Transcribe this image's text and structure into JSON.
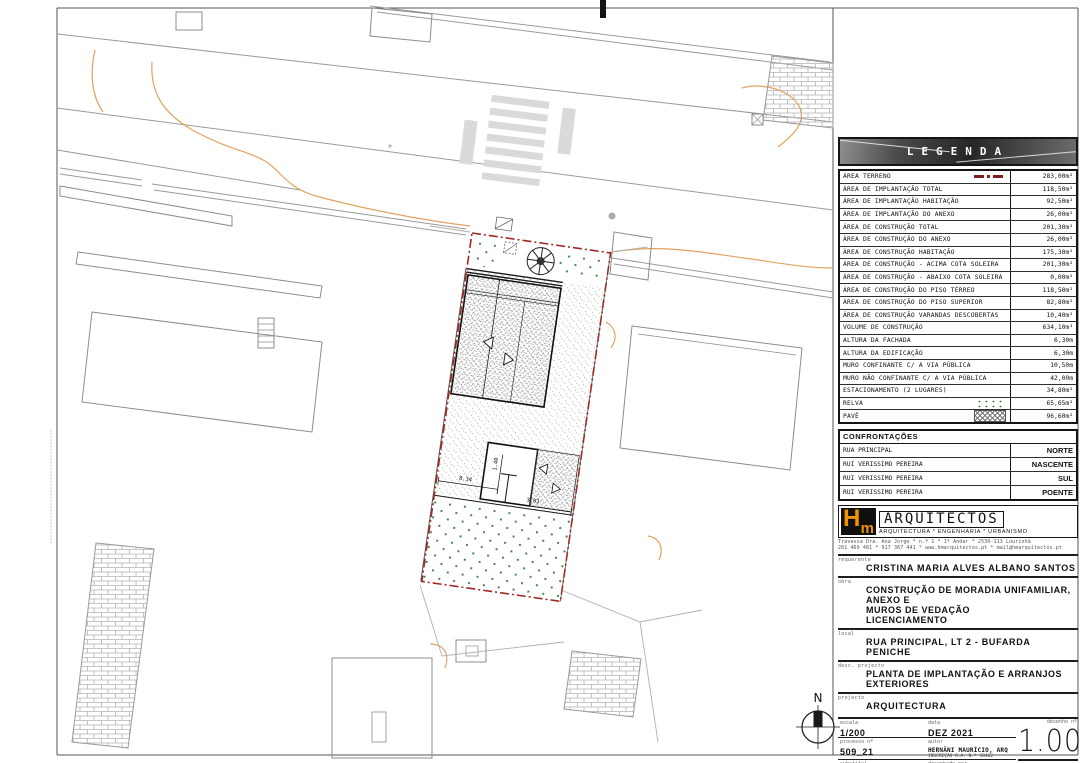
{
  "legend": {
    "title": "LEGENDA",
    "rows": [
      {
        "label": "ÁREA TERRENO",
        "value": "283,00m²",
        "symbol": "terrain"
      },
      {
        "label": "ÁREA DE IMPLANTAÇÃO TOTAL",
        "value": "118,50m²",
        "symbol": null
      },
      {
        "label": "ÁREA DE IMPLANTAÇÃO HABITAÇÃO",
        "value": "92,50m²",
        "symbol": null
      },
      {
        "label": "ÁREA DE IMPLANTAÇÃO DO ANEXO",
        "value": "26,00m²",
        "symbol": null
      },
      {
        "label": "ÁREA DE CONSTRUÇÃO TOTAL",
        "value": "201,30m²",
        "symbol": null
      },
      {
        "label": "ÁREA DE CONSTRUÇÃO DO ANEXO",
        "value": "26,00m²",
        "symbol": null
      },
      {
        "label": "ÁREA DE CONSTRUÇÃO HABITAÇÃO",
        "value": "175,30m²",
        "symbol": null
      },
      {
        "label": "ÁREA DE CONSTRUÇÃO - ACIMA COTA SOLEIRA",
        "value": "201,30m²",
        "symbol": null
      },
      {
        "label": "ÁREA DE CONSTRUÇÃO - ABAIXO COTA SOLEIRA",
        "value": "0,00m²",
        "symbol": null
      },
      {
        "label": "ÁREA DE CONSTRUÇÃO DO PISO TÉRREO",
        "value": "118,50m²",
        "symbol": null
      },
      {
        "label": "ÁREA DE CONSTRUÇÃO DO PISO SUPERIOR",
        "value": "82,80m²",
        "symbol": null
      },
      {
        "label": "ÁREA DE CONSTRUÇÃO VARANDAS DESCOBERTAS",
        "value": "10,40m²",
        "symbol": null
      },
      {
        "label": "VOLUME DE CONSTRUÇÃO",
        "value": "634,10m³",
        "symbol": null
      },
      {
        "label": "ALTURA DA FACHADA",
        "value": "6,30m",
        "symbol": null
      },
      {
        "label": "ALTURA DA EDIFICAÇÃO",
        "value": "6,30m",
        "symbol": null
      },
      {
        "label": "MURO CONFINANTE C/ A VIA PÚBLICA",
        "value": "10,50m",
        "symbol": null
      },
      {
        "label": "MURO NÃO CONFINANTE C/ A VIA PÚBLICA",
        "value": "42,00m",
        "symbol": null
      },
      {
        "label": "ESTACIONAMENTO (2 LUGARES)",
        "value": "34,80m²",
        "symbol": null
      },
      {
        "label": "RELVA",
        "value": "65,65m²",
        "symbol": "grass"
      },
      {
        "label": "PAVÊ",
        "value": "96,60m²",
        "symbol": "pave"
      }
    ]
  },
  "confrontations": {
    "title": "CONFRONTAÇÕES",
    "rows": [
      {
        "label": "RUA PRINCIPAL",
        "value": "NORTE"
      },
      {
        "label": "RUI VERISSIMO PEREIRA",
        "value": "NASCENTE"
      },
      {
        "label": "RUI VERISSIMO PEREIRA",
        "value": "SUL"
      },
      {
        "label": "RUI VERISSIMO PEREIRA",
        "value": "POENTE"
      }
    ]
  },
  "firm": {
    "logo_h": "H",
    "logo_m": "m",
    "name": "ARQUITECTOS",
    "tagline": "ARQUITECTURA * ENGENHARIA * URBANISMO",
    "address_line1": "Travessa Dra. Ana Jorge * n.º 1 * 1º Andar * 2530-113 Lourinhã",
    "address_line2": "261 469 481 * 917 367 441 * www.hmarquitectos.pt * mail@hmarquitectos.pt"
  },
  "titleblock": {
    "requerente_label": "requerente",
    "requerente": "CRISTINA MARIA ALVES ALBANO SANTOS",
    "obra_label": "obra",
    "obra_line1": "CONSTRUÇÃO DE MORADIA UNIFAMILIAR, ANEXO E",
    "obra_line2": "MUROS DE VEDAÇÃO",
    "obra_line3": "LICENCIAMENTO",
    "local_label": "local",
    "local_line1": "RUA PRINCIPAL, LT 2 - BUFARDA",
    "local_line2": "PENICHE",
    "desc_label": "desc. projecto",
    "desc": "PLANTA DE IMPLANTAÇÃO E ARRANJOS EXTERIORES",
    "projecto_label": "projecto",
    "projecto": "ARQUITECTURA",
    "escala_label": "escala",
    "escala": "1/200",
    "data_label": "data",
    "data": "DEZ 2021",
    "desenho_label": "desenho nº",
    "desenho": "1.00",
    "processo_label": "processo nº",
    "processo": "509_21",
    "autor_label": "autor",
    "autor": "HERNÂNI MAURÍCIO, ARQ",
    "autor_sub": "INSCRIÇÃO O.A. N.º 18462",
    "substitui_label": "substitui",
    "desenhado_label": "desenhado por",
    "data_sub_label": "data"
  },
  "plan": {
    "north_label": "N",
    "dimensions": [
      "8.34",
      "3.01",
      "1.40"
    ]
  },
  "colors": {
    "boundary_red": "#9E2B25",
    "terrain_symbol_red": "#7D1F1F",
    "grass_green": "#3B7D3B",
    "contour_orange": "#E2A35F",
    "logo_orange": "#F39200",
    "legend_header_bg": "#3F3F3F"
  }
}
